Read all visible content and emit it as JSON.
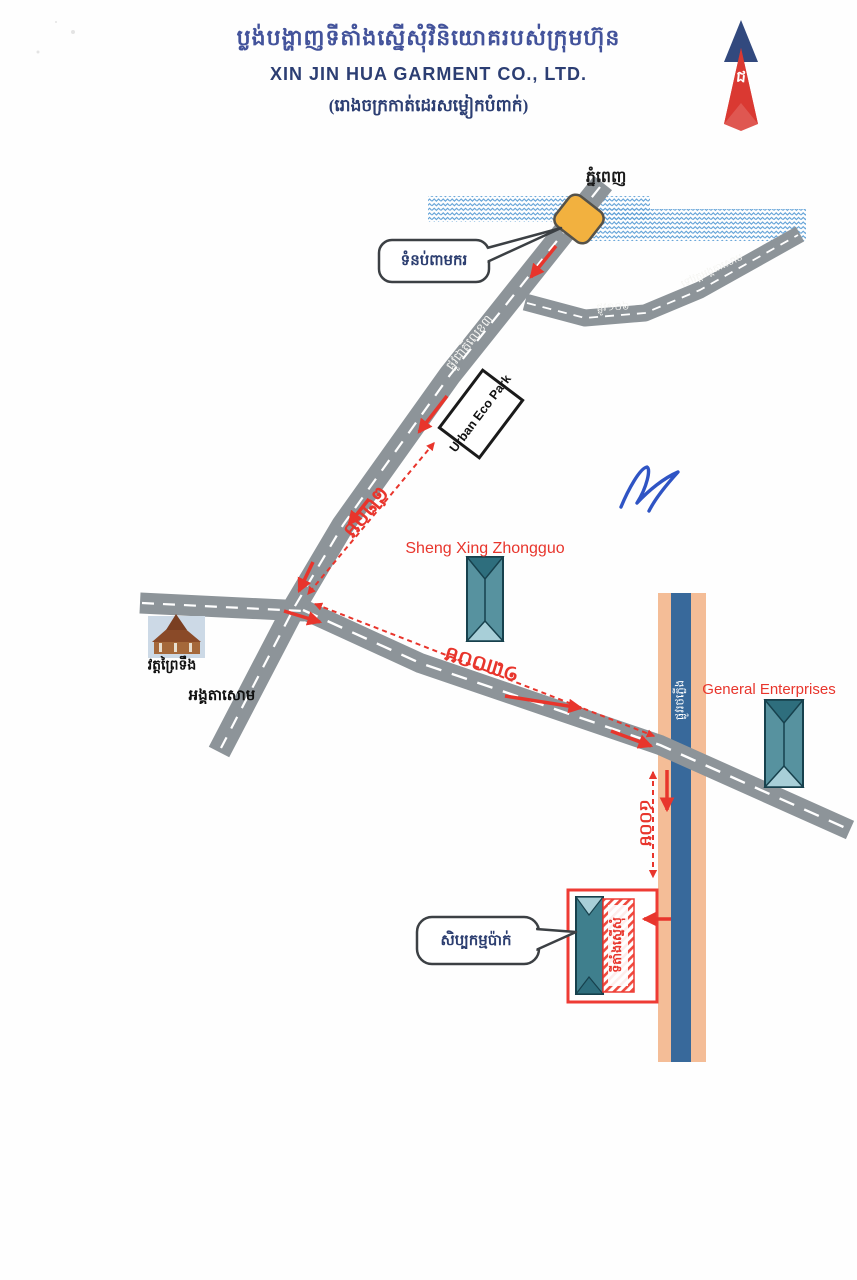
{
  "header": {
    "title_khmer": "ប្លង់បង្ហាញទីតាំងស្នើសុំវិនិយោគរបស់ក្រុមហ៊ុន",
    "title_english": "XIN JIN HUA GARMENT CO., LTD.",
    "subtitle_khmer": "(រោងចក្រកាត់ដេរសម្លៀកបំពាក់)"
  },
  "compass": {
    "glyph": "ជ"
  },
  "map": {
    "city_label": "ភ្នំពេញ",
    "dam_callout": "ទំនប់ពាមករ",
    "national_road_label": "ផ្លូវជាតិលេខ៣",
    "branch_road_label": "ទៅវត្តអង្គតាសោម",
    "street_label": "ផ្លូវ១០៦",
    "eco_park_label": "Urban Eco Park",
    "factory1_label": "Sheng Xing Zhongguo",
    "factory2_label": "General Enterprises",
    "temple_label": "វត្តព្រៃទឹង",
    "village_label": "អង្គតាសោម",
    "railway_label": "ផ្លូវរថភ្លើង",
    "site_label": "ទីតាំងស្នើសុំ",
    "workshop_callout": "សិប្បកម្មប៉ាក់",
    "distance_820m": "៨២០ម",
    "distance_1300m": "១៣០០ម",
    "distance_400m": "៤០០ម"
  },
  "colors": {
    "title_navy": "#43539b",
    "route_red": "#e8352c",
    "road_gray": "#8d9499",
    "water_blue": "#5d9fd6",
    "railway_peach": "#f4bd97",
    "railway_blue": "#38699b",
    "building_teal": "#57929f",
    "bridge_yellow": "#f2b13f"
  }
}
